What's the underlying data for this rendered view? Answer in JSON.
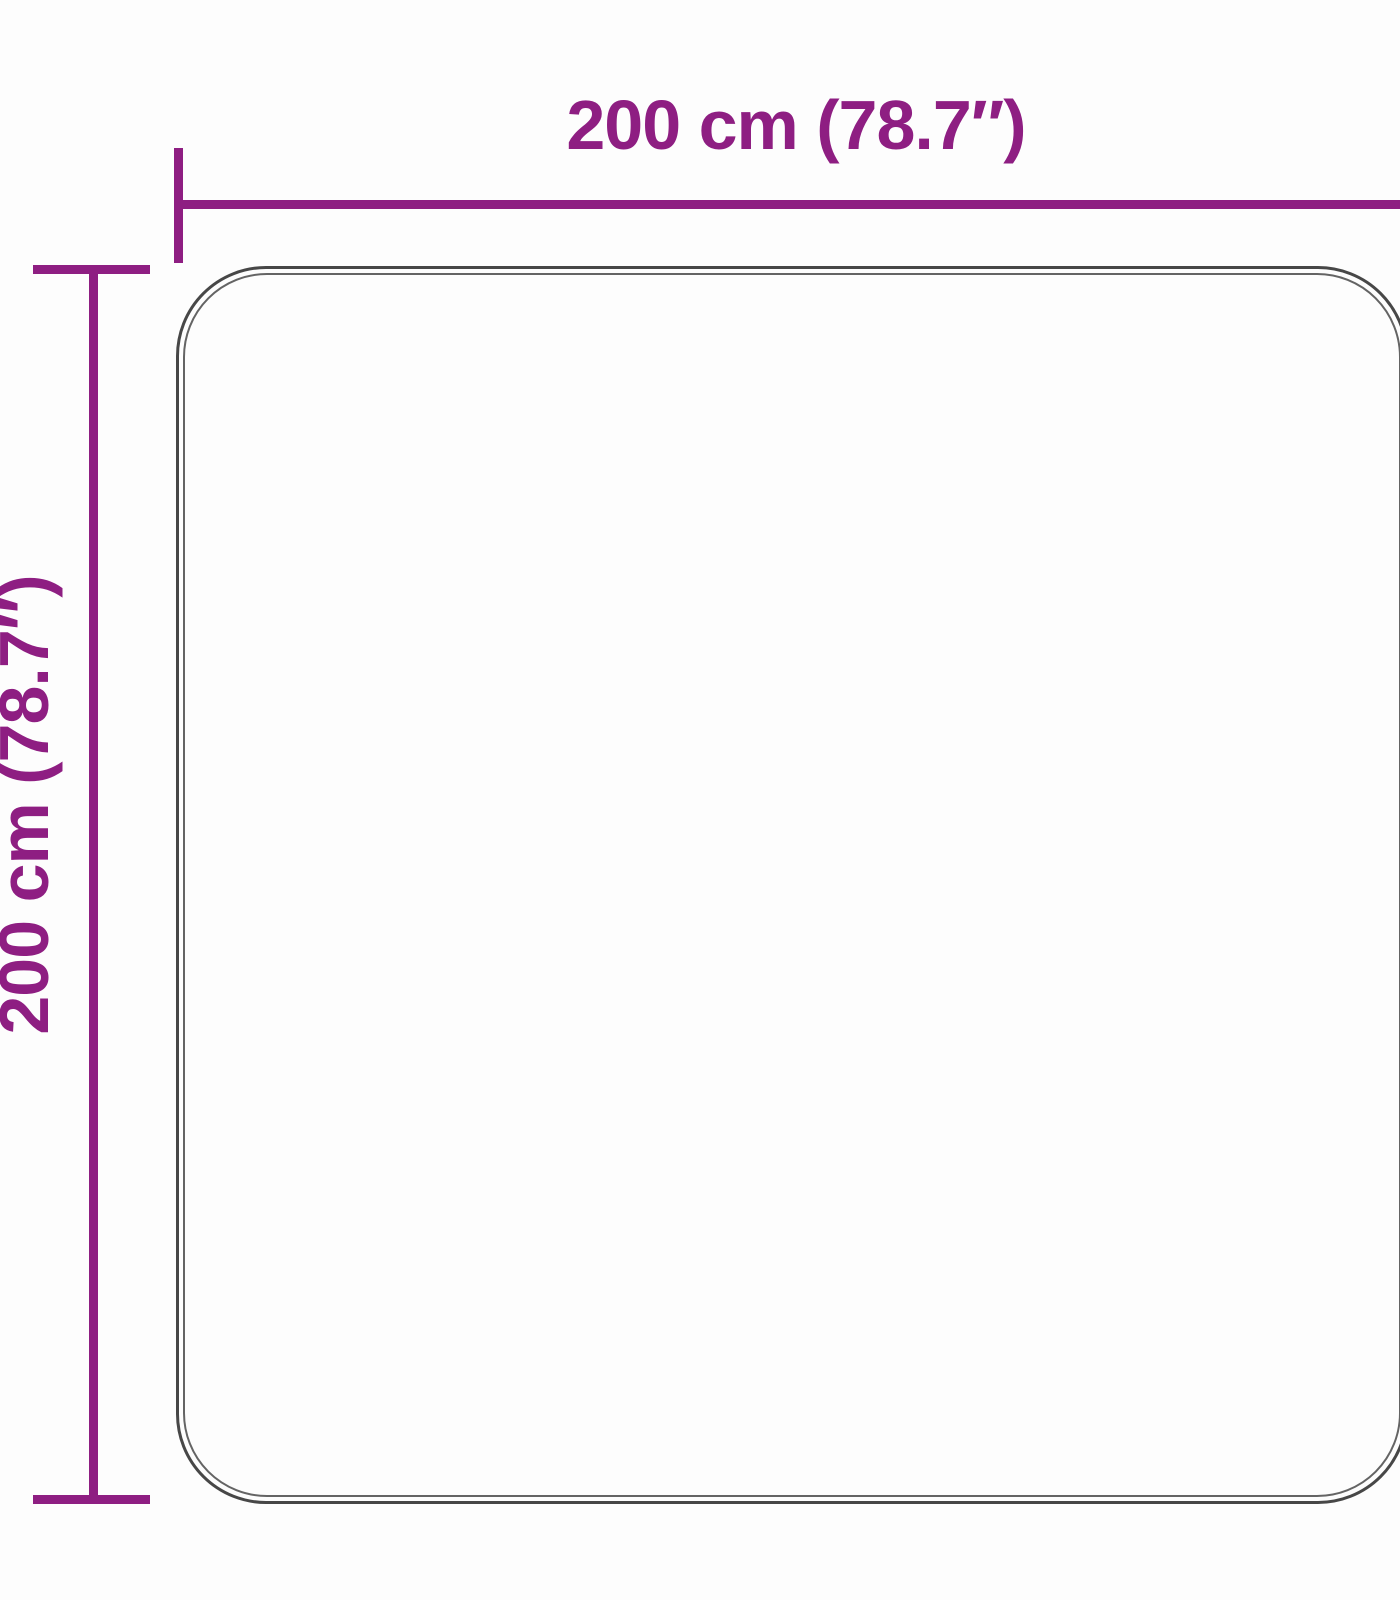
{
  "diagram": {
    "type": "product-dimension-diagram",
    "subject": "square rug outline with width and height dimensions",
    "width_dimension": {
      "label": "200 cm (78.7″)",
      "value_cm": 200,
      "value_inches": 78.7
    },
    "height_dimension": {
      "label": "200 cm (78.7″)",
      "value_cm": 200,
      "value_inches": 78.7
    },
    "colors": {
      "dimension": "#8e1e82",
      "outline_outer": "#474747",
      "outline_inner": "#646464",
      "background": "#fdfdfd"
    }
  }
}
